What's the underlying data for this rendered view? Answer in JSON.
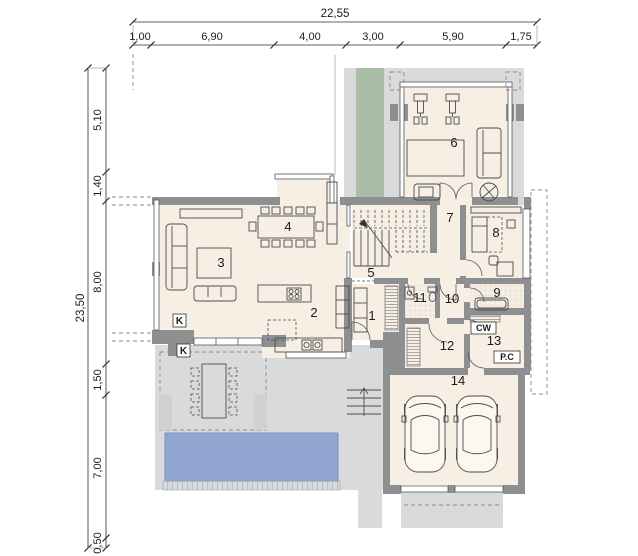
{
  "dims": {
    "top": {
      "total": "22,55",
      "segments": [
        "1,00",
        "6,90",
        "4,00",
        "3,00",
        "5,90",
        "1,75"
      ]
    },
    "left": {
      "total": "23,50",
      "segments": [
        "5,10",
        "1,40",
        "8,00",
        "1,50",
        "7,00",
        "0,50"
      ]
    }
  },
  "room_numbers": [
    "1",
    "2",
    "3",
    "4",
    "5",
    "6",
    "7",
    "8",
    "9",
    "10",
    "11",
    "12",
    "13",
    "14"
  ],
  "annotations": {
    "chimney": "K",
    "hot_water": "CW",
    "heat_pump": "P.C"
  },
  "colors": {
    "wall": "#8d8f91",
    "floor": "#f7efe3",
    "terrace": "#d8dadb",
    "green_strip": "#a9bda7",
    "pool": "#90a6d1"
  }
}
